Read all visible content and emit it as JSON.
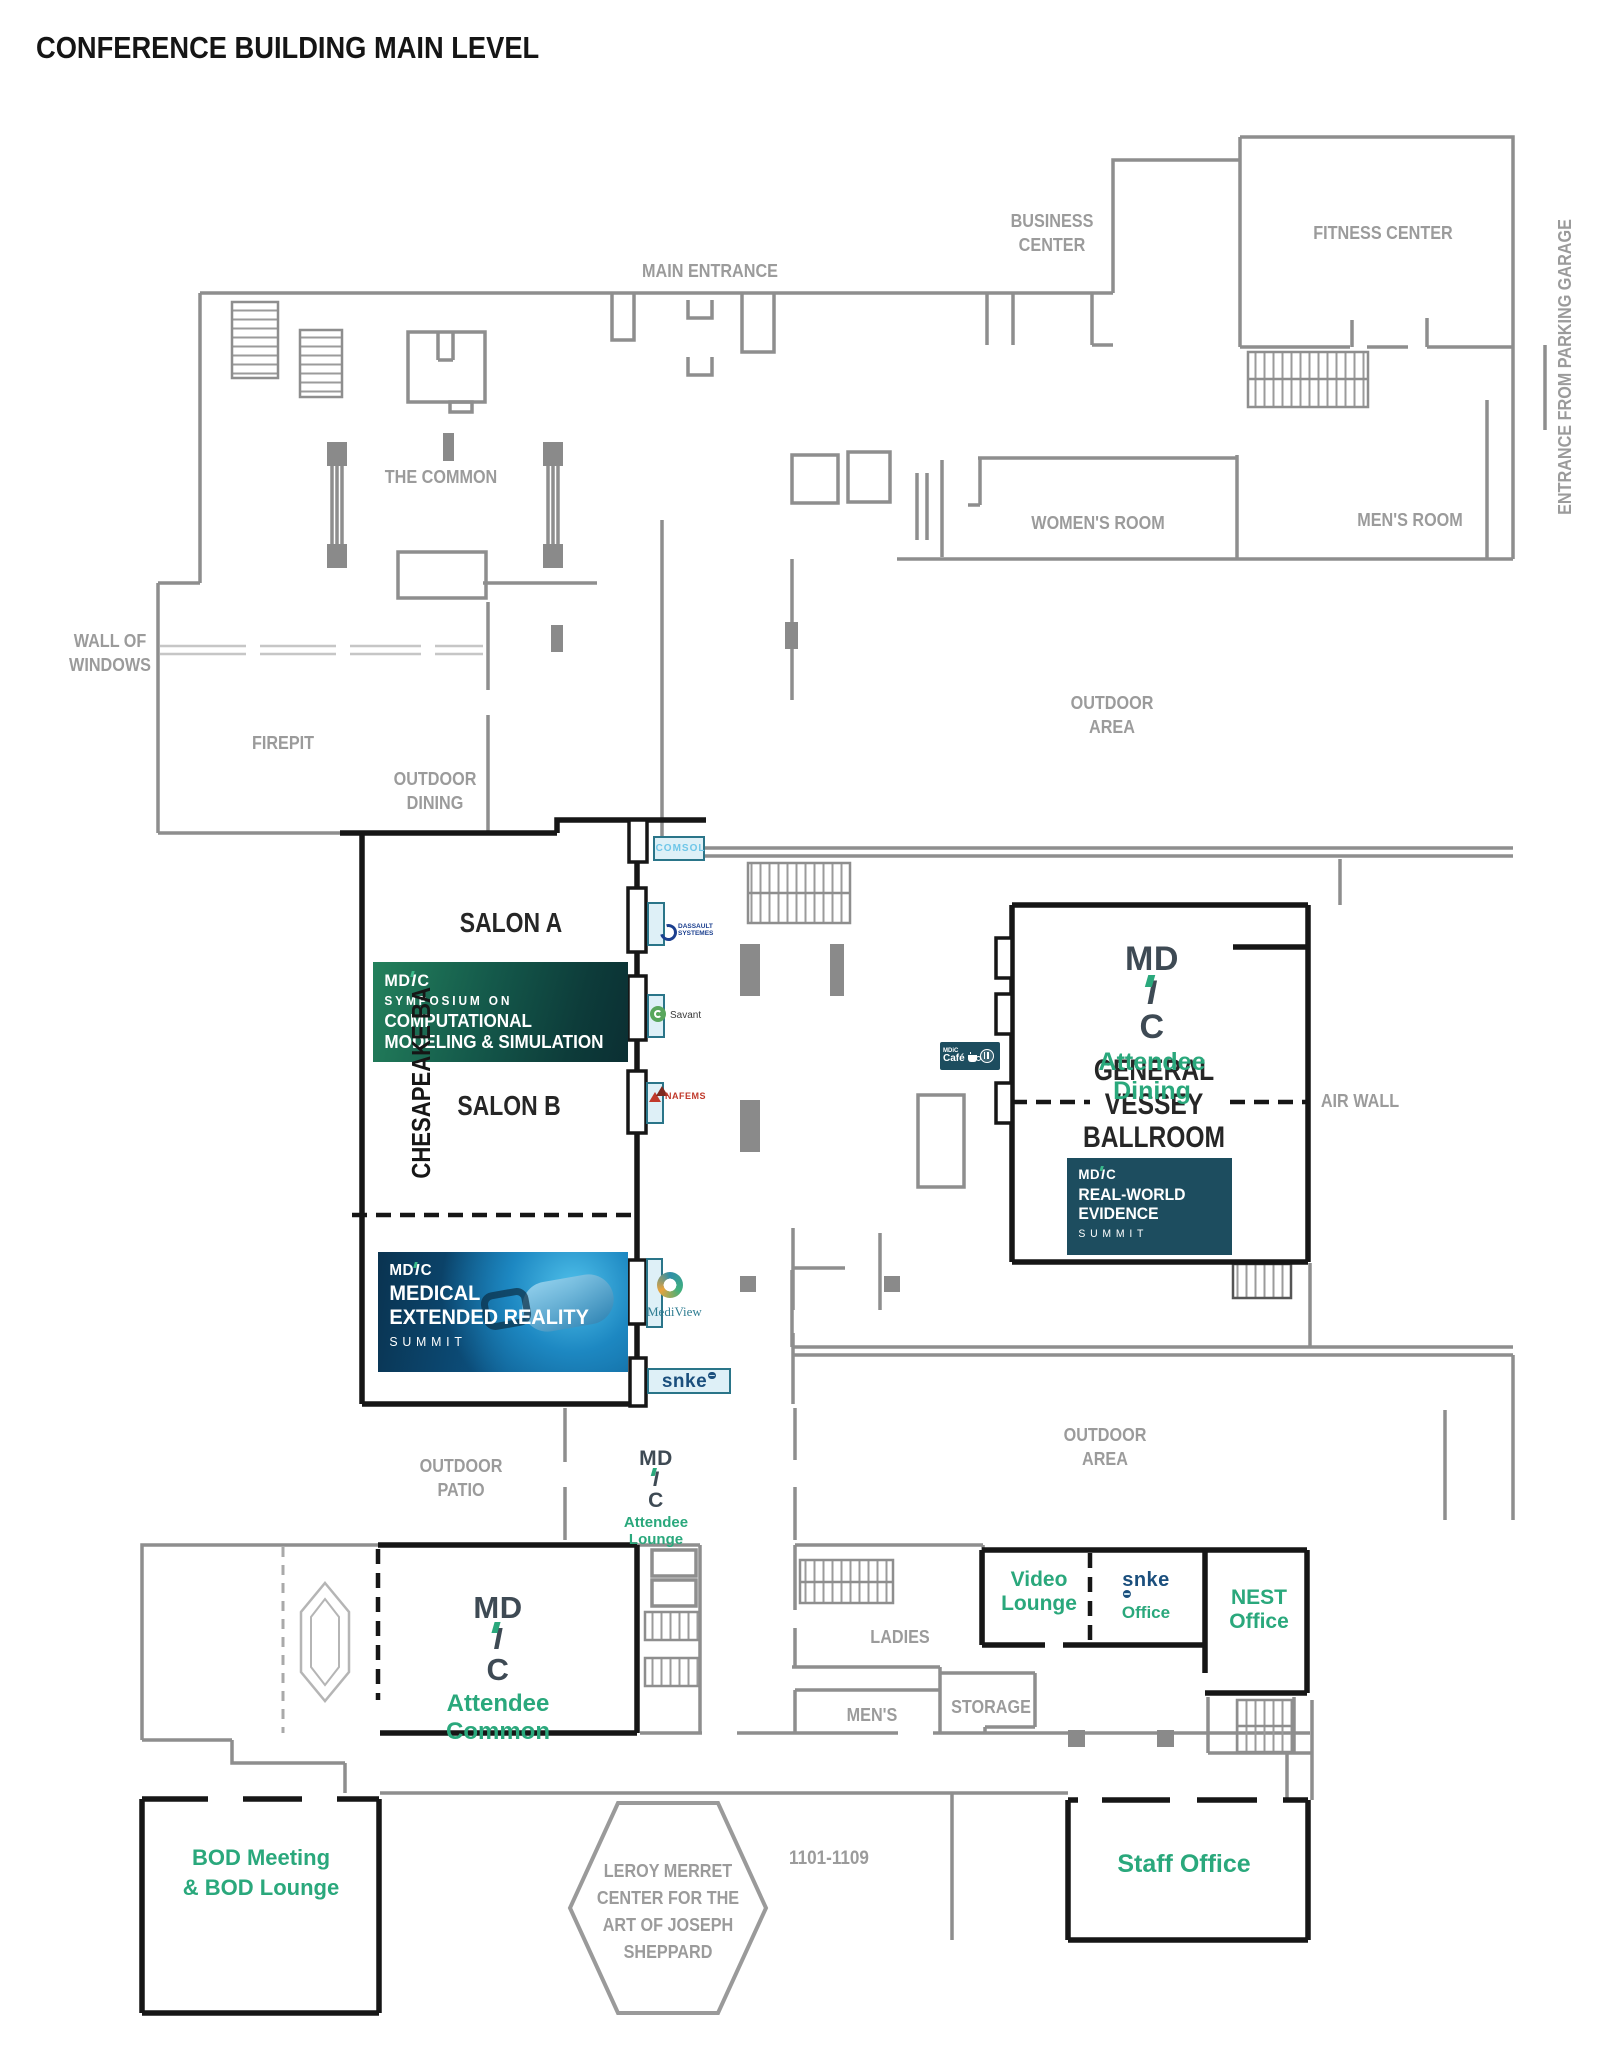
{
  "title": "CONFERENCE BUILDING MAIN LEVEL",
  "labels": {
    "main_entrance": "MAIN ENTRANCE",
    "business_center": [
      "BUSINESS",
      "CENTER"
    ],
    "fitness_center": "FITNESS CENTER",
    "parking_garage": "ENTRANCE FROM PARKING GARAGE",
    "the_common": "THE COMMON",
    "womens_room": "WOMEN'S ROOM",
    "mens_room": "MEN'S ROOM",
    "wall_of_windows": [
      "WALL OF",
      "WINDOWS"
    ],
    "firepit": "FIREPIT",
    "outdoor_dining": [
      "OUTDOOR",
      "DINING"
    ],
    "outdoor_area": [
      "OUTDOOR",
      "AREA"
    ],
    "outdoor_patio": [
      "OUTDOOR",
      "PATIO"
    ],
    "air_wall": "AIR WALL",
    "ladies": "LADIES",
    "mens": "MEN'S",
    "storage": "STORAGE",
    "rooms_1101": "1101-1109",
    "leroy_merret": [
      "LEROY MERRET",
      "CENTER FOR THE",
      "ART OF JOSEPH",
      "SHEPPARD"
    ],
    "salon_a": "SALON A",
    "salon_b": "SALON B",
    "chesapeake": "CHESAPEAKE BA",
    "vessey": [
      "GENERAL",
      "VESSEY",
      "BALLROOM"
    ]
  },
  "mdic_logo": {
    "md": "MD",
    "i": "I",
    "c": "C"
  },
  "rooms": {
    "attendee_dining": [
      "Attendee",
      "Dining"
    ],
    "attendee_lounge": [
      "Attendee",
      "Lounge"
    ],
    "attendee_common": [
      "Attendee",
      "Common"
    ],
    "video_lounge": [
      "Video",
      "Lounge"
    ],
    "snke_office": "Office",
    "nest_office": [
      "NEST",
      "Office"
    ],
    "staff_office": "Staff Office",
    "bod": [
      "BOD Meeting",
      "& BOD Lounge"
    ]
  },
  "banners": {
    "symposium": {
      "line1": "SYMPOSIUM ON",
      "line2": "COMPUTATIONAL",
      "line3": "MODELING & SIMULATION"
    },
    "mxr": {
      "line1": "MEDICAL",
      "line2": "EXTENDED REALITY",
      "line3": "SUMMIT"
    },
    "rwe": {
      "line1": "REAL-WORLD",
      "line2": "EVIDENCE",
      "line3": "SUMMIT"
    }
  },
  "logos": {
    "comsol": "COMSOL",
    "dassault": [
      "DASSAULT",
      "SYSTEMES"
    ],
    "savant": "Savant",
    "nafems": "NAFEMS",
    "mediview": "MediView",
    "snke": "snke",
    "cafe": [
      "MDiC",
      "Café"
    ]
  },
  "colors": {
    "accent_green": "#2aa87c",
    "mdic_dark": "#3e4a54",
    "snke_navy": "#1b4f7d",
    "banner_teal": "#1d4d5f",
    "banner_green_dark": "#0d3c3a",
    "banner_blue": "#0c5586",
    "wall_gray": "#8e8e8e",
    "wall_black": "#161616",
    "label_gray": "#9b9b9b"
  }
}
